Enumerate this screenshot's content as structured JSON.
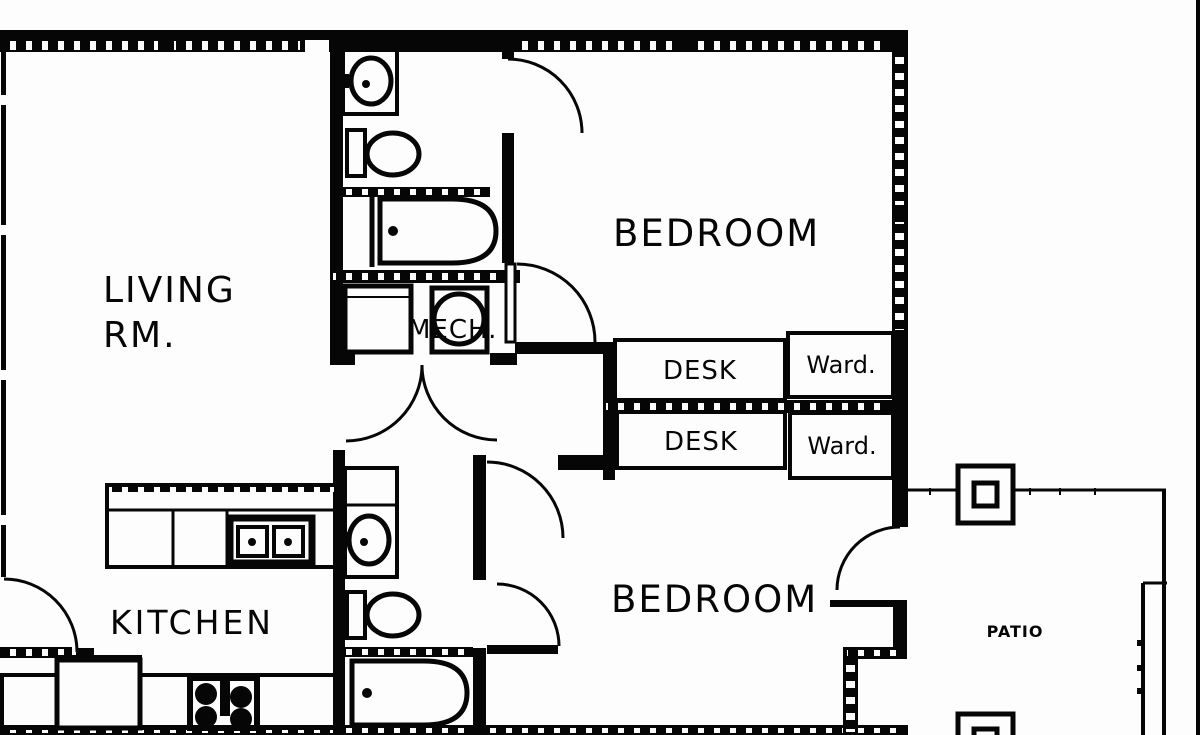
{
  "title": "Two-bedroom apartment floor plan",
  "labels": {
    "living_line1": "LIVING",
    "living_line2": "RM.",
    "kitchen": "KITCHEN",
    "mech": "MECH.",
    "bedroom_top": "BEDROOM",
    "bedroom_bottom": "BEDROOM",
    "desk_top": "DESK",
    "desk_bottom": "DESK",
    "wardrobe_top": "Ward.",
    "wardrobe_bottom": "Ward.",
    "patio": "PATIO"
  },
  "colors": {
    "ink": "#060606",
    "paper": "#fdfdfd"
  }
}
